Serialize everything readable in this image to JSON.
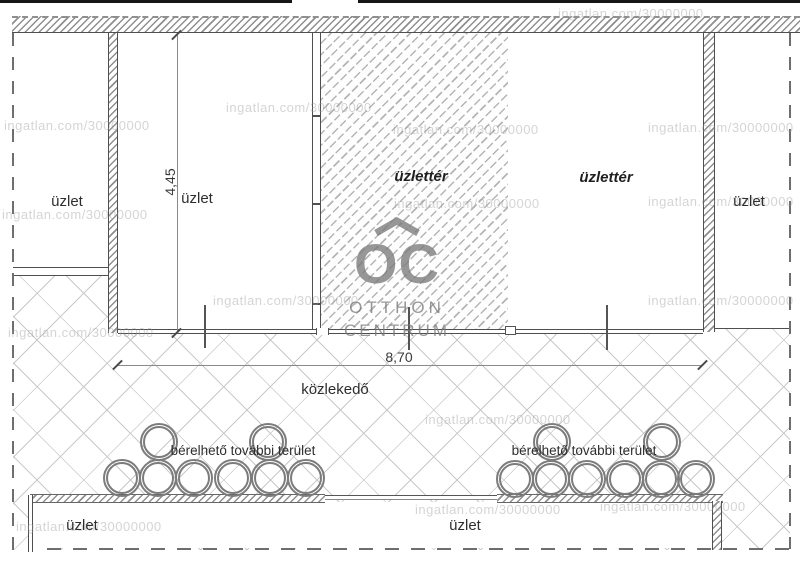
{
  "plan": {
    "room_labels": {
      "shop_left": "üzlet",
      "shop_top_2": "üzlet",
      "shop_space_hatched": "üzlettér",
      "shop_space_right": "üzlettér",
      "shop_right": "üzlet",
      "corridor": "közlekedő",
      "shop_bottom_left": "üzlet",
      "shop_bottom_center": "üzlet"
    },
    "annotations": {
      "rentable_left": "bérelhető további terület",
      "rentable_right": "bérelhető további terület"
    },
    "dimensions": {
      "room_height_m": "4,45",
      "frontage_width_m": "8,70"
    }
  },
  "watermark": {
    "text": "ingatlan.com/30000000"
  },
  "logo": {
    "monogram": "OC",
    "line1": "OTTHON",
    "line2": "CENTRUM"
  },
  "colors": {
    "wall_line": "#4f4f4f",
    "wall_hatch": "#8f8f8f",
    "room_hatch": "#b5b5b5",
    "corridor_crosshatch": "#c9c9c9",
    "watermark_gray": "#9a9a9a",
    "logo_gray": "#7a7a7a"
  }
}
